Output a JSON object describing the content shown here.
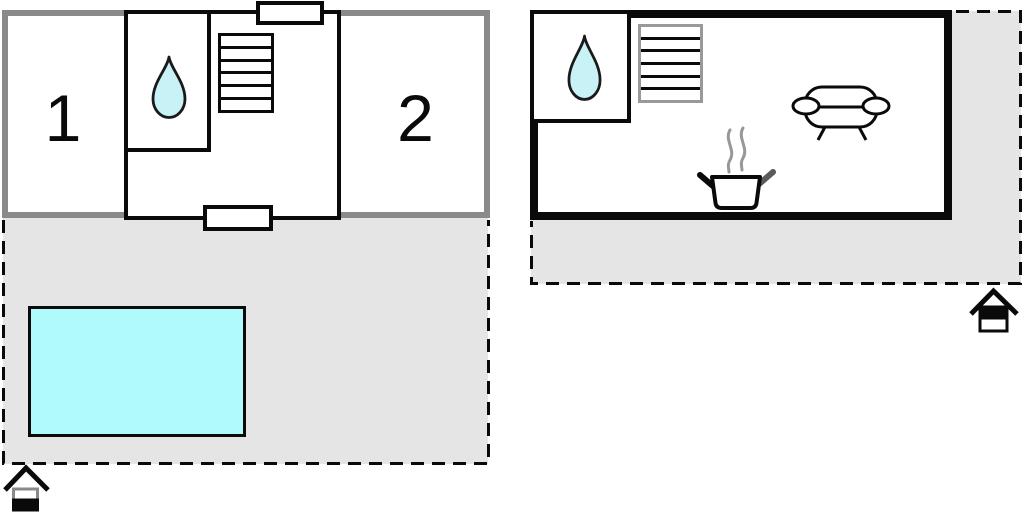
{
  "title": "Holiday home floor plan",
  "left_plan": {
    "rooms": [
      {
        "label": "1"
      },
      {
        "label": "2"
      }
    ],
    "icons": [
      "water-drop-icon",
      "stairs-icon",
      "swimming-pool",
      "door",
      "floor-level-house-icon"
    ]
  },
  "right_plan": {
    "icons": [
      "water-drop-icon",
      "stairs-icon",
      "sofa-icon",
      "cooking-pot-icon",
      "floor-level-house-icon"
    ]
  },
  "colors": {
    "wall-gray": "#8a8a8a",
    "wall-black": "#0a0a0a",
    "terrace": "#e5e5e5",
    "pool": "#b0fafc",
    "drop": "#c8f2f6",
    "stairs-gray": "#999999",
    "steam": "#979797",
    "handle-gray": "#5a5a5a"
  }
}
